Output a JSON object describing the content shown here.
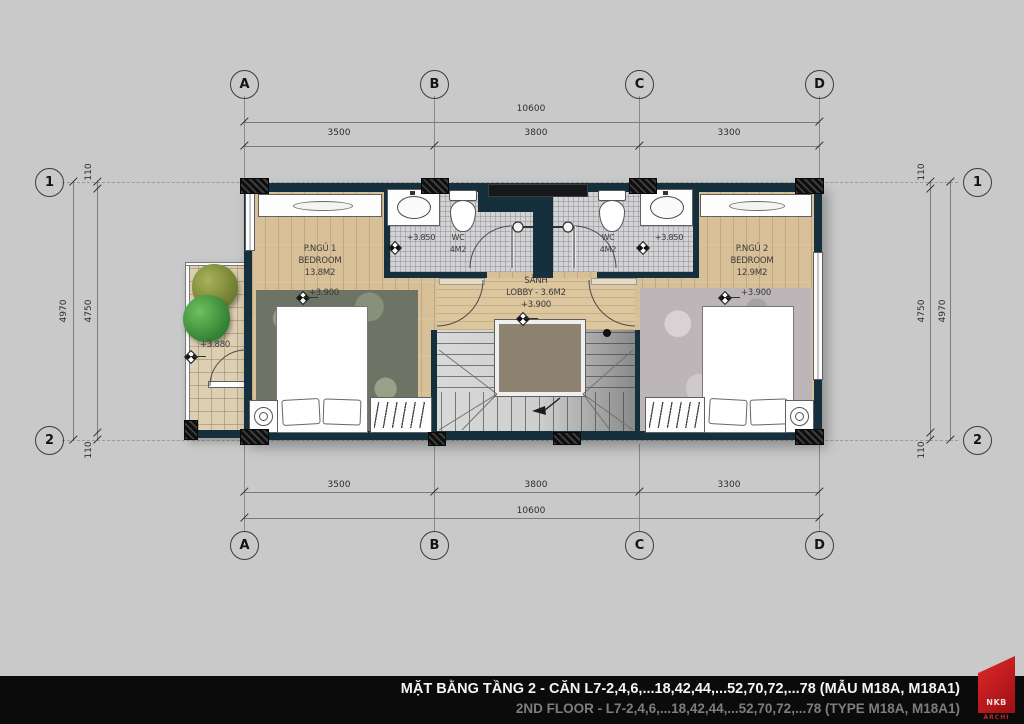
{
  "plan": {
    "grid": {
      "columns": [
        "A",
        "B",
        "C",
        "D"
      ],
      "rows": [
        "1",
        "2"
      ]
    },
    "dimensions": {
      "total_width": "10600",
      "spans": [
        "3500",
        "3800",
        "3300"
      ],
      "total_depth": "4970",
      "inner_depth": "4750",
      "edge_offset": "110"
    },
    "rooms": {
      "bedroom1": {
        "name_vi": "P.NGỦ 1",
        "name_en": "BEDROOM",
        "area": "13.8M2",
        "level": "+3.900"
      },
      "bedroom2": {
        "name_vi": "P.NGỦ 2",
        "name_en": "BEDROOM",
        "area": "12.9M2",
        "level": "+3.900"
      },
      "wc1": {
        "name": "WC",
        "area": "4M2",
        "level": "+3.850"
      },
      "wc2": {
        "name": "WC",
        "area": "4M2",
        "level": "+3.850"
      },
      "lobby": {
        "name_vi": "SẢNH",
        "name_en": "LOBBY - 3.6M2",
        "level": "+3.900"
      },
      "balcony": {
        "level": "+3.880"
      }
    }
  },
  "title_block": {
    "line_vi": "MẶT BẰNG TẦNG 2 - CĂN L7-2,4,6,...18,42,44,...52,70,72,...78 (MẪU M18A, M18A1)",
    "line_en": "2ND FLOOR - L7-2,4,6,...18,42,44,...52,70,72,...78 (TYPE M18A, M18A1)",
    "logo_text": "NKB",
    "logo_sub": "ARCHI"
  },
  "colors": {
    "wall": "#15303c",
    "accent_red": "#c41e20",
    "background": "#c9c9c9"
  }
}
